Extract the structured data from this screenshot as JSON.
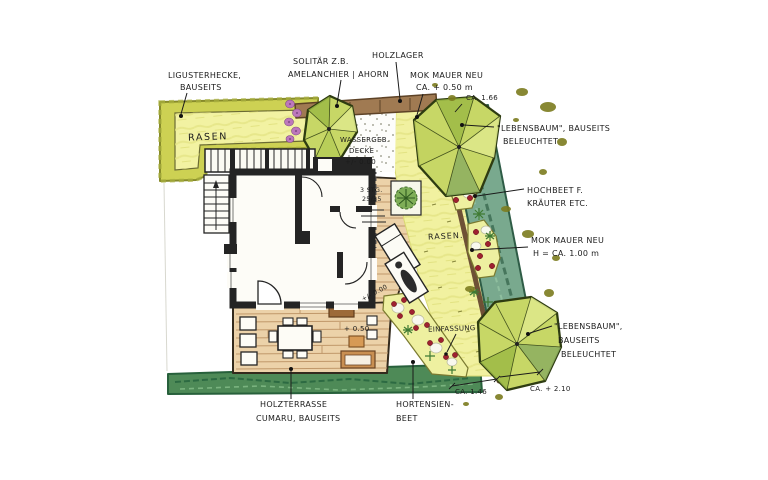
{
  "drawing": {
    "kind": "hand-drawn garden landscape plan with house floor plan"
  },
  "colors": {
    "lawn": "#f1f1a0",
    "hedge_yellow": "#cdd153",
    "hedge_dark_green": "#4e8a57",
    "hedge_teal": "#79a98e",
    "wood_deck": "#ecd2a9",
    "wall_brown": "#a07a52",
    "tree_canopy": "#c7d766",
    "berry_red": "#9e2130",
    "ink": "#1c1c1c"
  },
  "labels": {
    "ligusterhecke1": "LIGUSTERHECKE,",
    "ligusterhecke2": "BAUSEITS",
    "solitaer1": "SOLITÄR Z.B.",
    "solitaer2": "AMELANCHIER | AHORN",
    "holzlager": "HOLZLAGER",
    "mauer_top1": "MOK MAUER NEU",
    "mauer_top2": "CA. + 0.50 m",
    "ca_166": "CA. 1.66",
    "lebensbaum_top1": "\"LEBENSBAUM\", BAUSEITS",
    "lebensbaum_top2": "BELEUCHTET",
    "hochbeet1": "HOCHBEET F.",
    "hochbeet2": "KRÄUTER ETC.",
    "rasen_left": "RASEN",
    "rasen_center": "RASEN.",
    "mauer_right1": "MOK MAUER NEU",
    "mauer_right2": "H = CA. 1.00 m",
    "wassergeb1": "WASSERGEB.",
    "wassergeb2": "DECKE",
    "wassergeb3": "+/- 0.00",
    "stufen1": "3 STG.",
    "stufen2": "25/35",
    "level_deck": "+/- 0.00",
    "level_terrace": "+ 0.50",
    "einfassung": "EINFASSUNG",
    "lebensbaum_bot1": "\"LEBENSBAUM\",",
    "lebensbaum_bot2": "BAUSEITS",
    "lebensbaum_bot3": "BELEUCHTET",
    "ca_146": "CA. 1.46",
    "ca_210": "CA. + 2.10",
    "holzterrasse1": "HOLZTERRASSE",
    "holzterrasse2": "CUMARU, BAUSEITS",
    "hortensien1": "HORTENSIEN-",
    "hortensien2": "BEET"
  }
}
